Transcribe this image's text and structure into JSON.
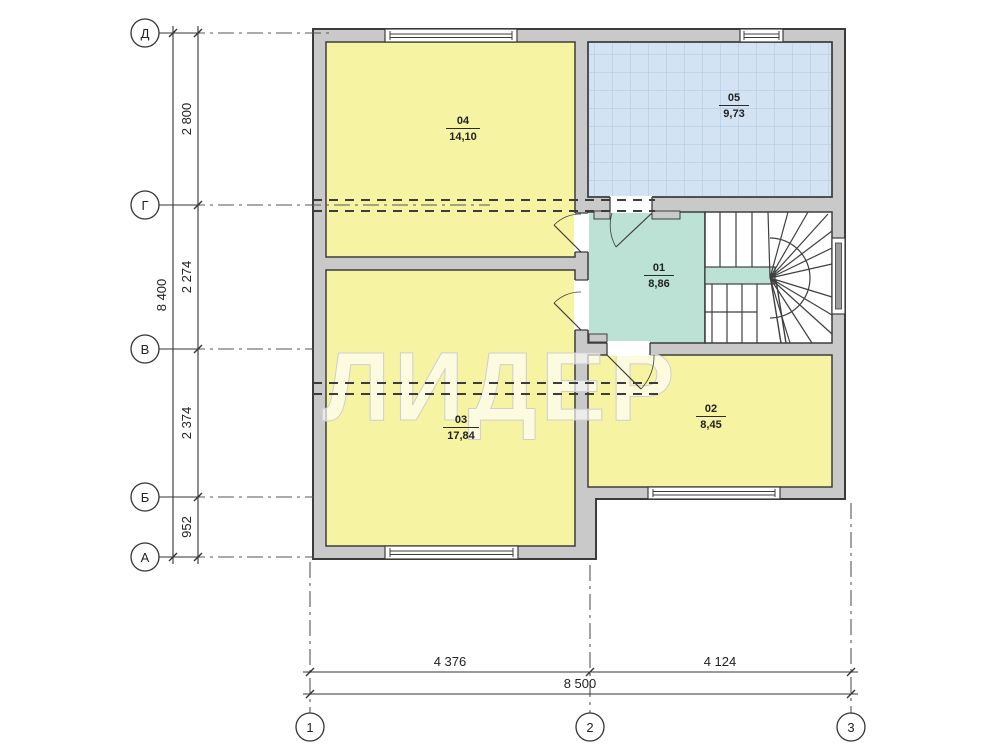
{
  "watermark": "ЛИДЕР",
  "axes": {
    "left": [
      {
        "label": "Д"
      },
      {
        "label": "Г"
      },
      {
        "label": "В"
      },
      {
        "label": "Б"
      },
      {
        "label": "А"
      }
    ],
    "bottom": [
      {
        "label": "1"
      },
      {
        "label": "2"
      },
      {
        "label": "3"
      }
    ]
  },
  "dimensions": {
    "left_segments": [
      "2 800",
      "2 274",
      "2 374",
      "952"
    ],
    "left_total": "8 400",
    "bottom_segments": [
      "4 376",
      "4 124"
    ],
    "bottom_total": "8 500"
  },
  "rooms": [
    {
      "number": "01",
      "area": "8,86"
    },
    {
      "number": "02",
      "area": "8,45"
    },
    {
      "number": "03",
      "area": "17,84"
    },
    {
      "number": "04",
      "area": "14,10"
    },
    {
      "number": "05",
      "area": "9,73"
    }
  ],
  "colors": {
    "room_yellow": "#f6f3a3",
    "room_blue": "#d3e3f4",
    "room_teal": "#bce2d6",
    "wall_fill": "#c9c9c9",
    "line": "#3d3d3d"
  }
}
